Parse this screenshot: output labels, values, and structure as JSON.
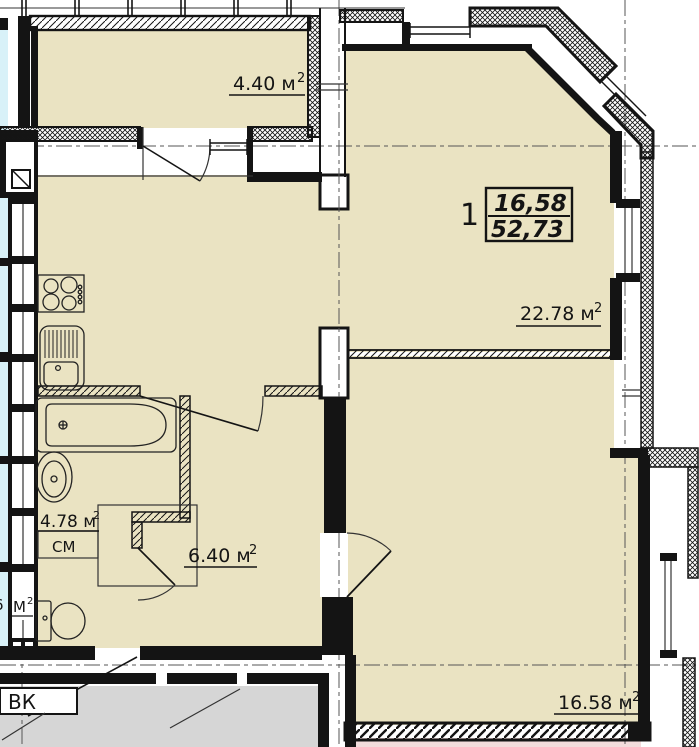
{
  "plan": {
    "info_box": {
      "rooms_count": "1",
      "living_area": "16,58",
      "total_area": "52,73"
    },
    "rooms": {
      "balcony": {
        "label": "4.40 м",
        "sup": "2"
      },
      "kitchen_living": {
        "label": "22.78 м",
        "sup": "2"
      },
      "bathroom": {
        "label": "4.78 м",
        "sup": "2"
      },
      "hallway": {
        "label": "6.40 м",
        "sup": "2"
      },
      "bedroom": {
        "label": "16.58 м",
        "sup": "2"
      }
    },
    "annotations": {
      "vk": "ВК",
      "washing_machine": "СМ",
      "shaft_label": "М",
      "shaft_sup": "2",
      "edge_partial_digit": "6"
    }
  },
  "colors": {
    "floor": "#eae3c2",
    "corridor": "#d6d6d6",
    "neighbor": "#f3dcdc",
    "stair": "#d8f1f8",
    "wall": "#141414",
    "line": "#555555"
  }
}
